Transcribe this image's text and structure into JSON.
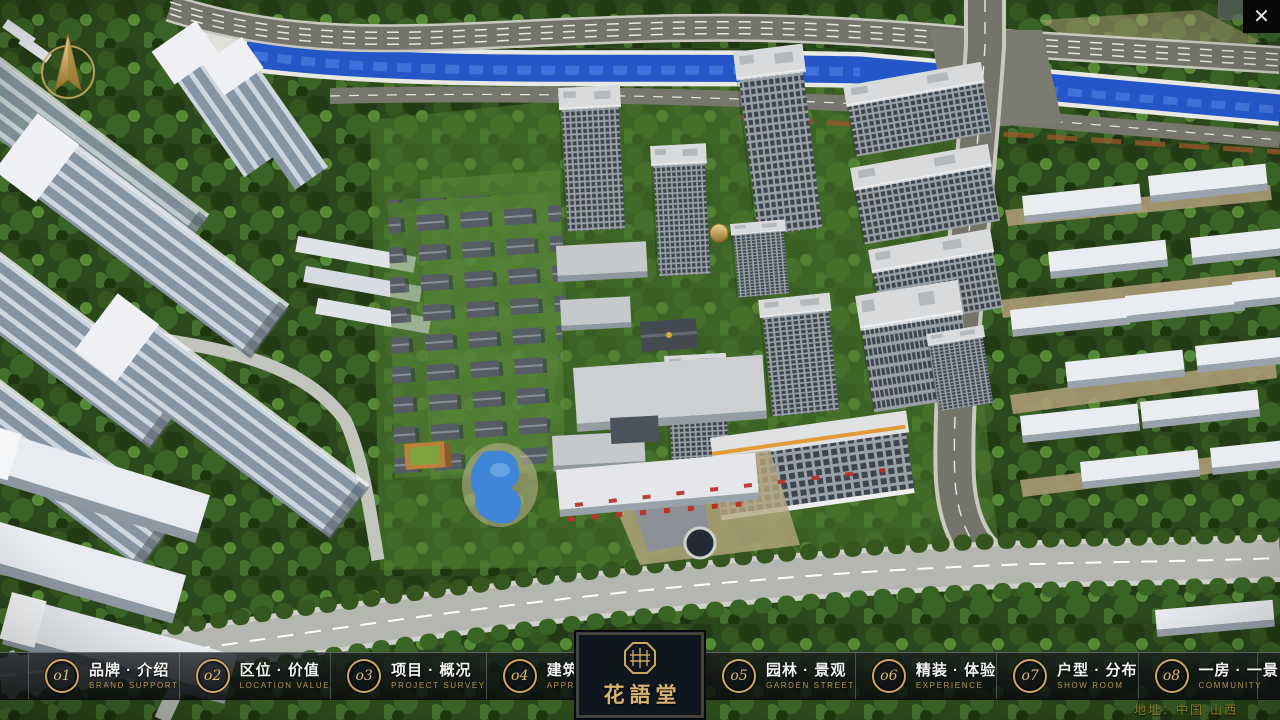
{
  "window": {
    "close_icon": "✕"
  },
  "nav": {
    "items": [
      {
        "num": "o1",
        "label": "品牌 · 介绍",
        "sub": "BRAND SUPPORT"
      },
      {
        "num": "o2",
        "label": "区位 · 价值",
        "sub": "LOCATION VALUE"
      },
      {
        "num": "o3",
        "label": "项目 · 概况",
        "sub": "PROJECT SURVEY"
      },
      {
        "num": "o4",
        "label": "建筑 · 鉴赏",
        "sub": "APPRECIATION"
      },
      {
        "num": "o5",
        "label": "园林 · 景观",
        "sub": "GARDEN STREET"
      },
      {
        "num": "o6",
        "label": "精装 · 体验",
        "sub": "EXPERIENCE"
      },
      {
        "num": "o7",
        "label": "户型 · 分布",
        "sub": "SHOW ROOM"
      },
      {
        "num": "o8",
        "label": "一房 · 一景",
        "sub": "COMMUNITY"
      }
    ]
  },
  "logo": {
    "title": "花語堂"
  },
  "footer": {
    "address": "地址：中国·山西"
  },
  "colors": {
    "gold": "#cfa95f",
    "nav_bg": "#14181c",
    "river": "#2456c8",
    "lawn": "#4f7a30"
  }
}
